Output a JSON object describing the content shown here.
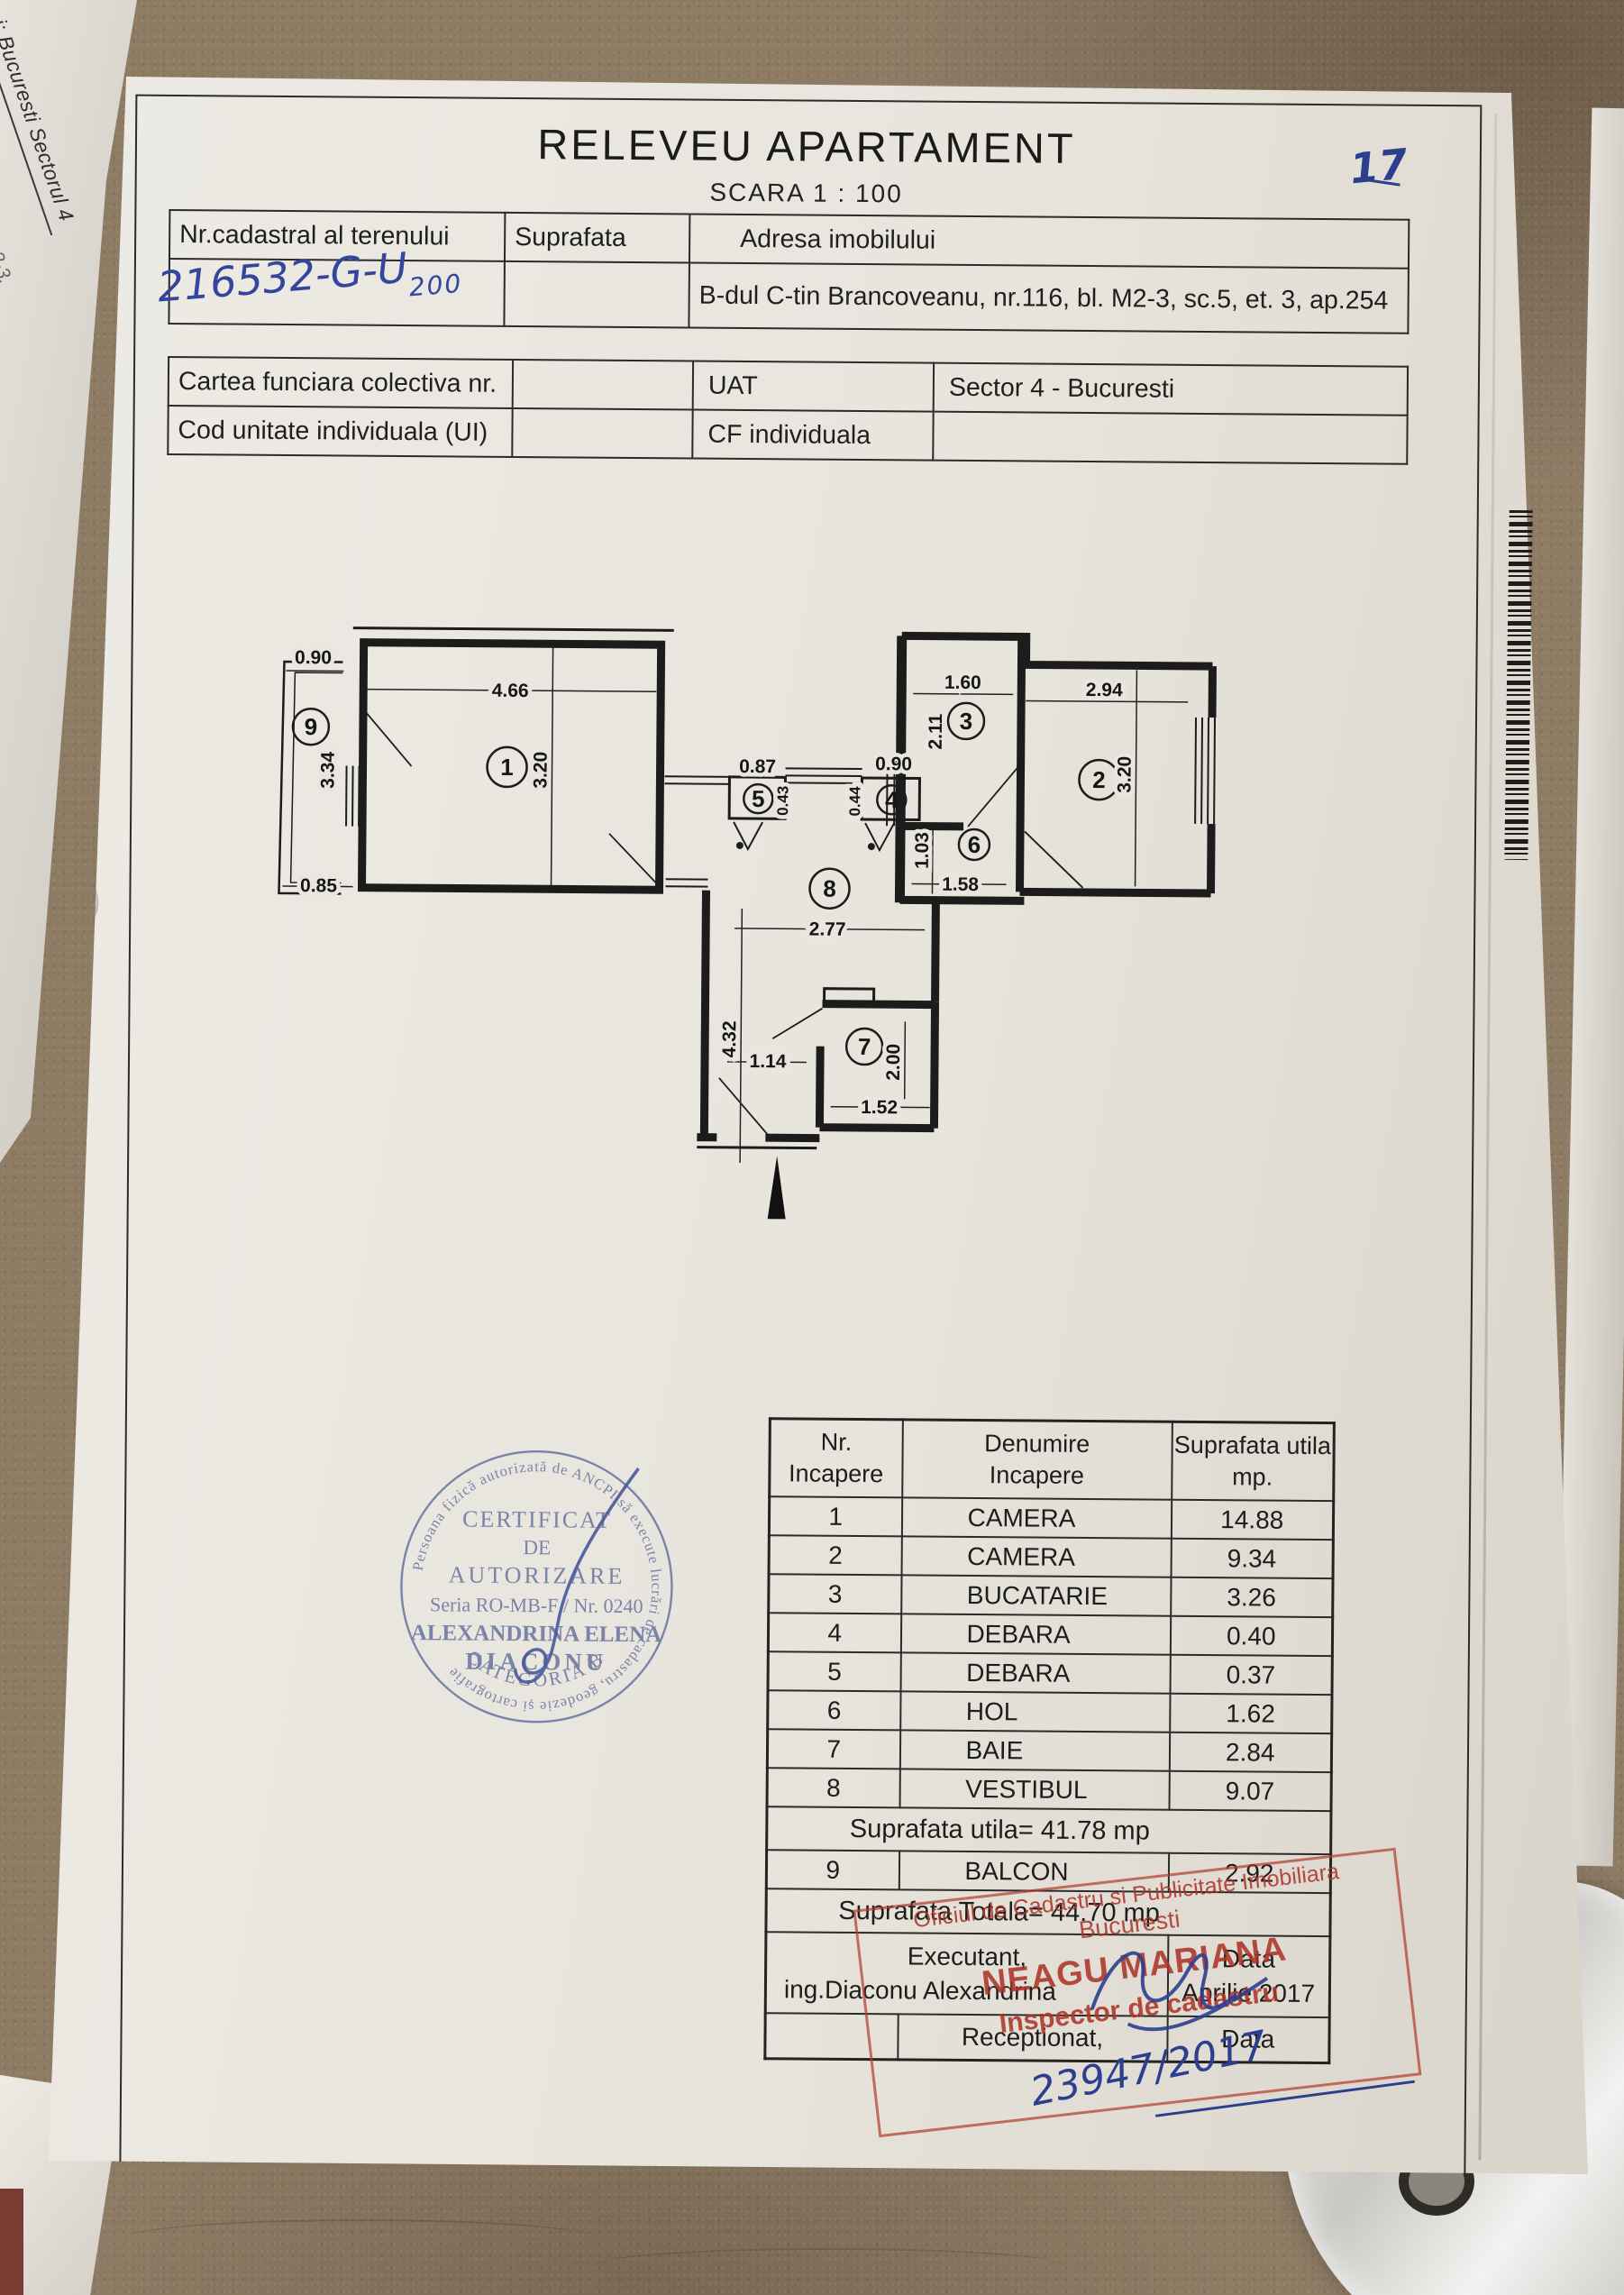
{
  "background": {
    "side_note": "i: Bucuresti Sectorul 4",
    "side_note_2": "2-3,"
  },
  "paper": {
    "corner_note": "17"
  },
  "title": "RELEVEU  APARTAMENT",
  "subtitle": "SCARA  1 : 100",
  "table1": {
    "col1": "Nr.cadastral al terenului",
    "col2": "Suprafata",
    "col3": "Adresa imobilului",
    "cadastral_number": "216532-G-U",
    "cadastral_number_sub": "200",
    "address": "B-dul C-tin Brancoveanu, nr.116, bl. M2-3, sc.5, et. 3, ap.254"
  },
  "table2": {
    "row1_label": "Cartea funciara colectiva nr.",
    "row2_label": "Cod unitate individuala (UI)",
    "uat_label": "UAT",
    "uat_value": "Sector 4 - Bucuresti",
    "cf_label": "CF individuala"
  },
  "plan": {
    "rooms": {
      "r1": "1",
      "r2": "2",
      "r3": "3",
      "r4": "4",
      "r5": "5",
      "r6": "6",
      "r7": "7",
      "r8": "8",
      "r9": "9"
    },
    "dims": {
      "balcony_top": "0.90",
      "balcony_left": "3.34",
      "balcony_bottom": "0.85",
      "room1_w": "4.66",
      "room1_h": "3.20",
      "deb5_w": "0.87",
      "deb5_h": "0.43",
      "deb4_w": "0.90",
      "deb4_h": "0.44",
      "kitchen_w": "1.60",
      "kitchen_h": "2.11",
      "room2_w": "2.94",
      "room2_h": "3.20",
      "hol_h": "1.03",
      "hol_w": "1.58",
      "vest_w": "2.77",
      "vest_h": "4.32",
      "bath_door": "1.14",
      "bath_h": "2.00",
      "bath_w": "1.52"
    }
  },
  "round_stamp": {
    "arc_text": "Persoana fizică autorizată de ANCPI să execute lucrări de cadastru, geodezie și cartografie",
    "line1": "CERTIFICAT",
    "line2": "DE",
    "line3": "AUTORIZARE",
    "line4": "Seria RO-MB-F / Nr. 0240",
    "line5": "ALEXANDRINA ELENA",
    "line6": "DIACONU",
    "category": "CATEGORIA B"
  },
  "room_table": {
    "header": {
      "col1a": "Nr.",
      "col1b": "Incapere",
      "col2a": "Denumire",
      "col2b": "Incapere",
      "col3a": "Suprafata utila",
      "col3b": "mp."
    },
    "rows": [
      {
        "nr": "1",
        "name": "CAMERA",
        "area": "14.88"
      },
      {
        "nr": "2",
        "name": "CAMERA",
        "area": "9.34"
      },
      {
        "nr": "3",
        "name": "BUCATARIE",
        "area": "3.26"
      },
      {
        "nr": "4",
        "name": "DEBARA",
        "area": "0.40"
      },
      {
        "nr": "5",
        "name": "DEBARA",
        "area": "0.37"
      },
      {
        "nr": "6",
        "name": "HOL",
        "area": "1.62"
      },
      {
        "nr": "7",
        "name": "BAIE",
        "area": "2.84"
      },
      {
        "nr": "8",
        "name": "VESTIBUL",
        "area": "9.07"
      }
    ],
    "subtotal": "Suprafata utila= 41.78 mp",
    "balcony_row": {
      "nr": "9",
      "name": "BALCON",
      "area": "2.92"
    },
    "total": "Suprafata Totala= 44.70 mp",
    "executant_label": "Executant,",
    "executant_name": "ing.Diaconu Alexandrina",
    "data_label": "Data",
    "data_value": "Aprilie 2017",
    "receptionat_label": "Receptionat,",
    "receptionat_data_label": "Data"
  },
  "red_stamp": {
    "line1": "Oficiul de Cadastru si Publicitate Imobiliara",
    "line2": "Bucuresti",
    "line3": "NEAGU MARIANA",
    "line4": "Inspector de cadastru",
    "registration_number": "23947/2017"
  }
}
